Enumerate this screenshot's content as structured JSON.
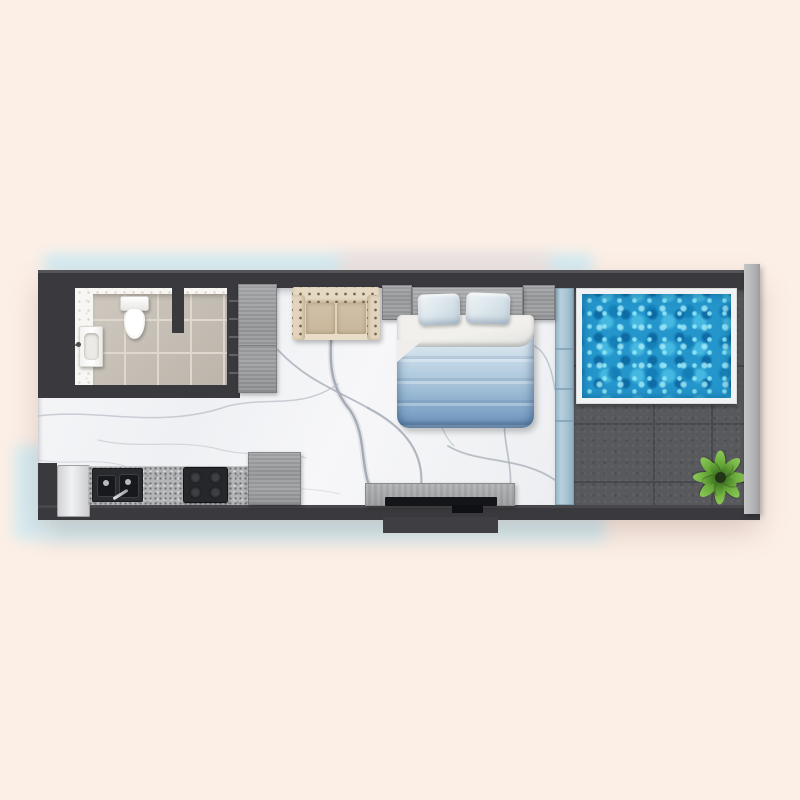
{
  "scene": {
    "kind": "top-view 3D rendered floor plan of a studio apartment with private pool",
    "text_visible": "none",
    "rooms": [
      {
        "name": "bathroom",
        "floor": "beige ceramic tile over white terrazzo",
        "fixtures": [
          "toilet",
          "wash-basin with wall faucet",
          "partition wall stub",
          "wall shelf niche"
        ]
      },
      {
        "name": "living-bedroom",
        "floor": "white marble with gray veins",
        "furniture": [
          "tall gray wardrobe",
          "beige tufted loveseat sofa",
          "double bed with gray headboard",
          "two nightstands",
          "two light-blue pillows",
          "ombre blue duvet",
          "tv console with tv"
        ]
      },
      {
        "name": "kitchen-strip",
        "furniture": [
          "white fridge",
          "granite countertop",
          "black double-bowl sink with faucet",
          "black 4-burner cooktop",
          "gray base cabinet"
        ]
      },
      {
        "name": "pool-terrace",
        "floor": "dark gray large tiles",
        "features": [
          "rectangular pool with white coping",
          "green potted plant",
          "light gray parapet rail"
        ],
        "separator": "light blue glass wall"
      }
    ]
  },
  "colors": {
    "background": "#fcefe6",
    "background_wash_blue": "#cdeaf3",
    "wall_dark": "#3a3a3e",
    "wall_highlight": "#55555a",
    "outer_rail_gray": "#b7b8ba",
    "marble_base": "#f4f5f7",
    "marble_vein": "#a9afb8",
    "bath_tile": "#c7c0b5",
    "tile_grout": "#ded8cf",
    "terrazzo": "#f7f6f2",
    "wood_gray": "#9b9c9e",
    "sofa_beige": "#e0d2ba",
    "sofa_cushion": "#cdbda2",
    "pillow_blue": "#dde7ed",
    "duvet_top_sheet": "#eceae5",
    "duvet_blue_deep": "#7299bf",
    "glass_wall_blue": "#a7c3d3",
    "deck_tile": "#57595c",
    "deck_grout": "#46484b",
    "pool_coping_white": "#f1f2f3",
    "pool_water_base": "#2496cc",
    "pool_water_light": "#7fdcef",
    "pool_water_deep": "#0c6ca4",
    "granite_counter": "#b4b5b7",
    "appliance_black": "#26272a",
    "fridge_white": "#eceded",
    "plant_green": "#6fb03f"
  }
}
